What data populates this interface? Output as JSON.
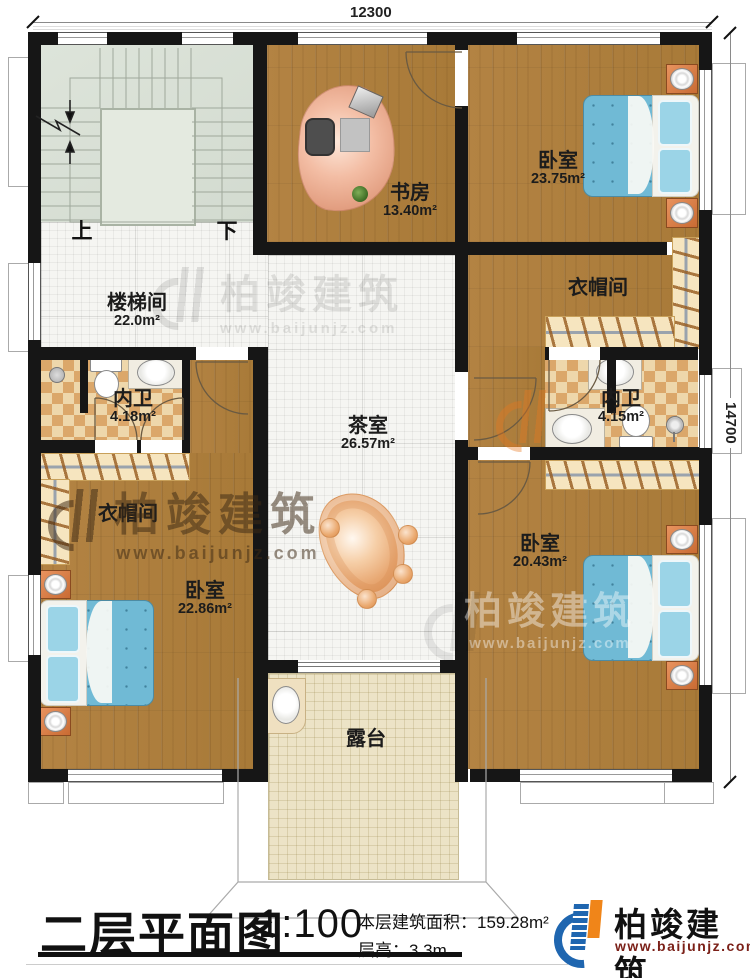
{
  "title_block": {
    "plan_title": "二层平面图",
    "scale": "1:100",
    "floor_area": "本层建筑面积：159.28m²",
    "floor_height": "层高：3.3m"
  },
  "brand": {
    "name": "柏竣建筑",
    "website": "www.baijunjz.com"
  },
  "watermark": {
    "name": "柏竣建筑",
    "website": "www.baijunjz.com"
  },
  "dimensions": {
    "width": "12300",
    "height": "14700"
  },
  "stairs": {
    "up_label": "上",
    "down_label": "下"
  },
  "rooms": {
    "stairwell": {
      "name": "楼梯间",
      "area": "22.0m²"
    },
    "study": {
      "name": "书房",
      "area": "13.40m²"
    },
    "bedroom_ne": {
      "name": "卧室",
      "area": "23.75m²"
    },
    "cloakroom_e": {
      "name": "衣帽间"
    },
    "bath_e": {
      "name": "内卫",
      "area": "4.15m²"
    },
    "tearoom": {
      "name": "茶室",
      "area": "26.57m²"
    },
    "bath_w": {
      "name": "内卫",
      "area": "4.18m²"
    },
    "cloakroom_w": {
      "name": "衣帽间"
    },
    "bedroom_sw": {
      "name": "卧室",
      "area": "22.86m²"
    },
    "bedroom_se": {
      "name": "卧室",
      "area": "20.43m²"
    },
    "terrace": {
      "name": "露台"
    }
  },
  "colors": {
    "wall": "#161616",
    "wood": "#b08040",
    "bed_blue": "#70bad5",
    "brand_blue": "#1f66b0",
    "brand_orange": "#f08519",
    "brand_url_red": "#7b2018"
  }
}
